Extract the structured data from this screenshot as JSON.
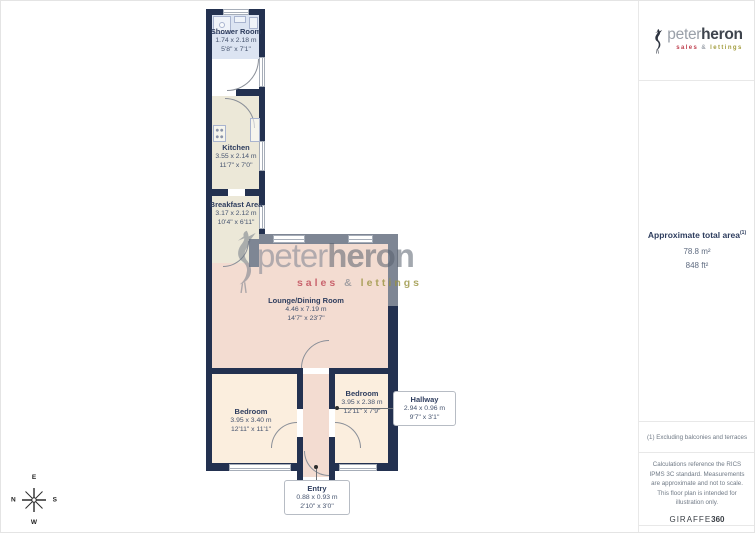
{
  "logo": {
    "peter": "peter",
    "heron": "heron",
    "sales": "sales",
    "amp": "&",
    "lettings": "lettings"
  },
  "watermark": {
    "peter": "peter",
    "heron": "heron",
    "sales": "sales",
    "amp": "&",
    "lettings": "lettings"
  },
  "rooms": {
    "shower": {
      "name": "Shower Room",
      "metric": "1.74 x 2.18 m",
      "imperial": "5'8\" x 7'1\""
    },
    "kitchen": {
      "name": "Kitchen",
      "metric": "3.55 x 2.14 m",
      "imperial": "11'7\" x 7'0\""
    },
    "breakfast": {
      "name": "Breakfast Area",
      "metric": "3.17 x 2.12 m",
      "imperial": "10'4\" x 6'11\""
    },
    "lounge": {
      "name": "Lounge/Dining Room",
      "metric": "4.46 x 7.19 m",
      "imperial": "14'7\" x 23'7\""
    },
    "bedroom1": {
      "name": "Bedroom",
      "metric": "3.95 x 3.40 m",
      "imperial": "12'11\" x 11'1\""
    },
    "bedroom2": {
      "name": "Bedroom",
      "metric": "3.95 x 2.38 m",
      "imperial": "12'11\" x 7'9\""
    },
    "hallway": {
      "name": "Hallway",
      "metric": "2.94 x 0.96 m",
      "imperial": "9'7\" x 3'1\""
    },
    "entry": {
      "name": "Entry",
      "metric": "0.88 x 0.93 m",
      "imperial": "2'10\" x 3'0\""
    }
  },
  "compass": {
    "n": "N",
    "e": "E",
    "s": "S",
    "w": "W"
  },
  "sidebar": {
    "area_title": "Approximate total area",
    "area_sup": "(1)",
    "area_m2": "78.8 m²",
    "area_ft2": "848 ft²",
    "footnote": "(1) Excluding balconies and terraces",
    "disclaimer": "Calculations reference the RICS IPMS 3C standard. Measurements are approximate and not to scale. This floor plan is intended for illustration only.",
    "brand": "GIRAFFE",
    "brand_bold": "360"
  },
  "colors": {
    "wall_navy": "#233150",
    "wall_gray": "#7e8694",
    "shower_floor": "#dce4f2",
    "kitchen_floor": "#ece8d8",
    "lounge_floor": "#f3dcd1",
    "bedroom_floor": "#fbeede",
    "label_navy": "#2e3d5e",
    "logo_red": "#bf3f4e",
    "logo_olive": "#a39d3e"
  }
}
